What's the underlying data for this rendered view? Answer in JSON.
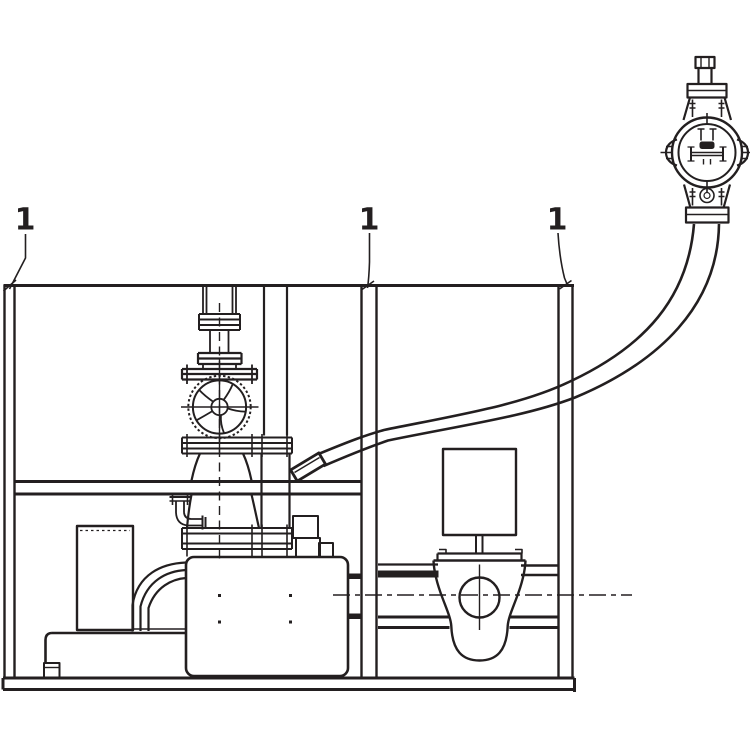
{
  "drawing": {
    "kind": "technical-line-drawing",
    "colors": {
      "ink": "#231f20",
      "background": "#ffffff"
    }
  },
  "callouts": {
    "left": "1",
    "center": "1",
    "right": "1"
  }
}
